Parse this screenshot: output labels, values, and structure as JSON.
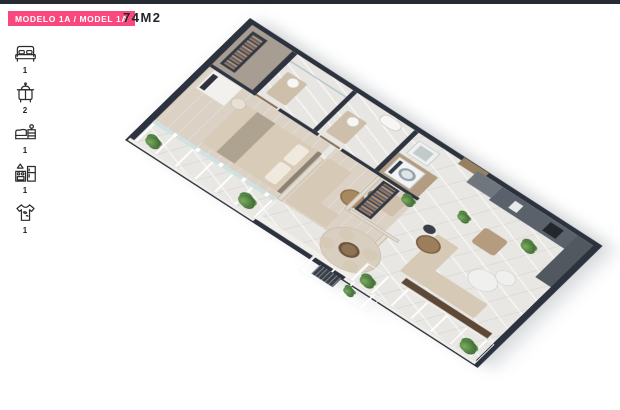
{
  "header": {
    "badge": "MODELO 1A / MODEL 1A",
    "area": "74M2"
  },
  "sidebar": {
    "items": [
      {
        "id": "bedrooms",
        "icon": "bed-icon",
        "count": "1"
      },
      {
        "id": "bathrooms",
        "icon": "bathtub-icon",
        "count": "2"
      },
      {
        "id": "living",
        "icon": "sofa-icon",
        "count": "1"
      },
      {
        "id": "kitchen",
        "icon": "kitchen-icon",
        "count": "1"
      },
      {
        "id": "laundry",
        "icon": "shirt-icon",
        "count": "1"
      }
    ]
  },
  "plan": {
    "type": "isometric-3d-floor-plan",
    "rooms": [
      "master-bedroom",
      "walk-in-closet",
      "bathroom-1",
      "bathroom-2",
      "tv-lounge",
      "wardrobe-nook",
      "laundry",
      "kitchen",
      "living-dining",
      "bedroom-balcony",
      "living-balcony"
    ]
  },
  "colors": {
    "accent": "#F9487D",
    "wall_dark": "#2C323E",
    "glass": "#CFE4E4",
    "floor_marble": "#E9E7E3",
    "floor_wood": "#DBD1C4",
    "furniture_beige": "#D6C9B5",
    "kitchen_counter": "#5A616B",
    "plant_green": "#4E8040"
  }
}
